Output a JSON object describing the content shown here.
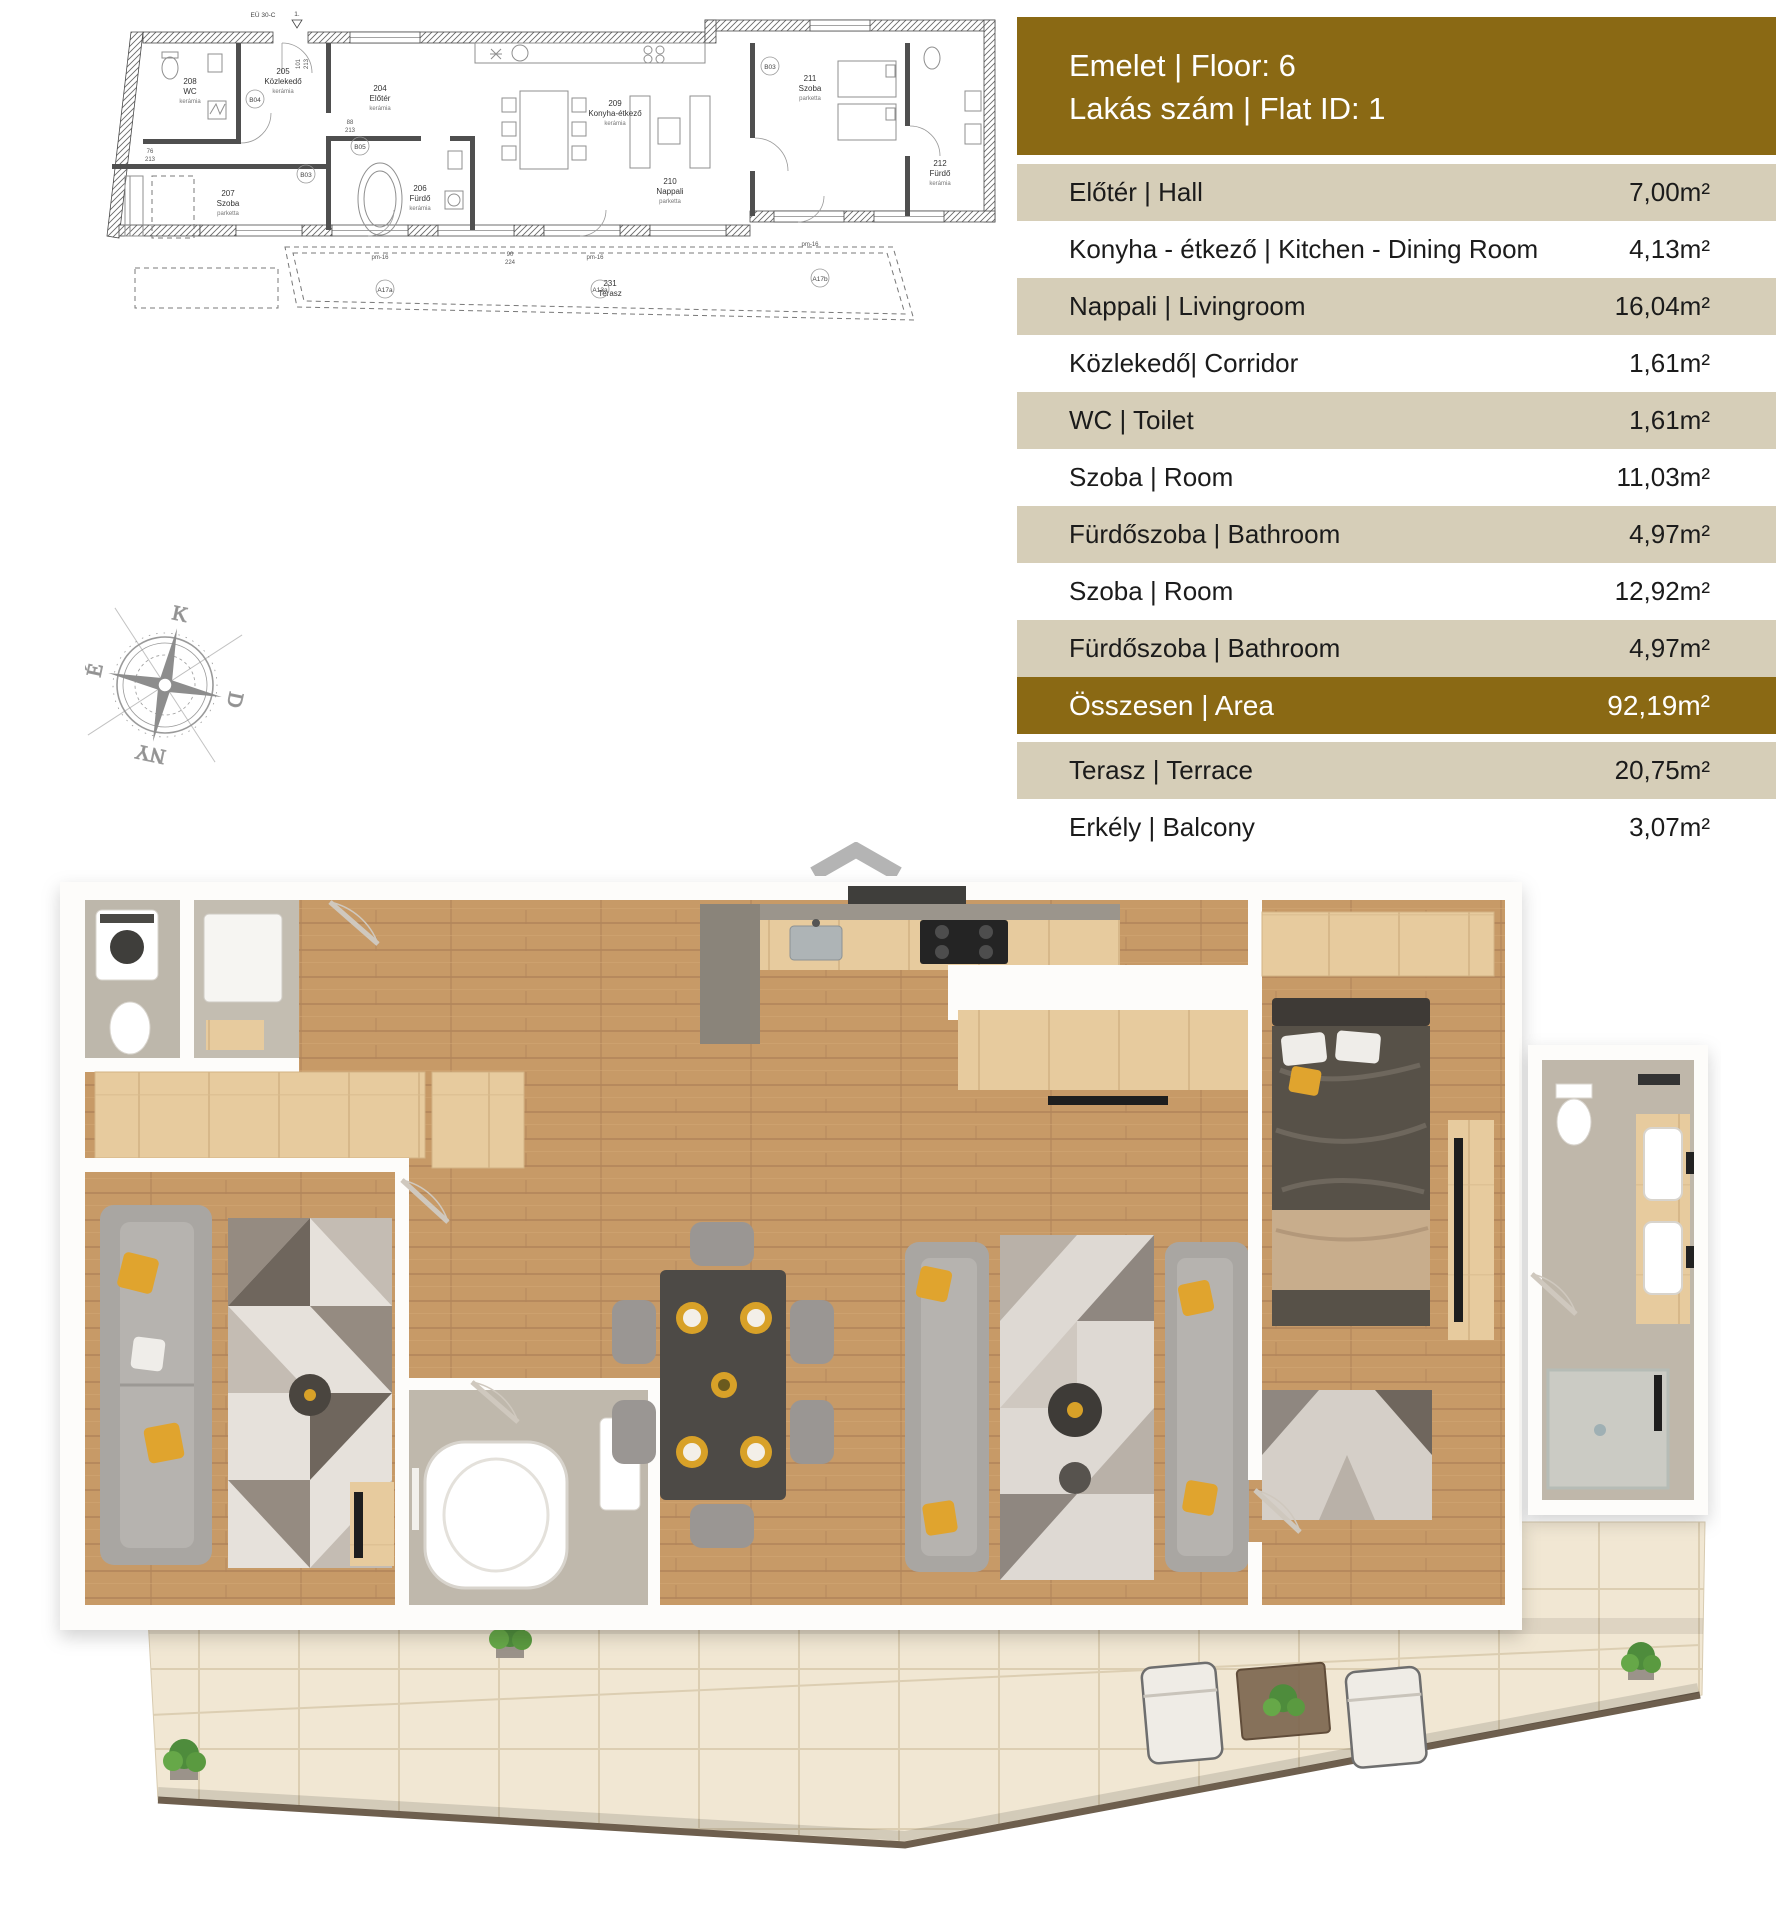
{
  "header": {
    "line1": "Emelet | Floor: 6",
    "line2": "Lakás szám | Flat ID: 1"
  },
  "table": {
    "rows": [
      {
        "label": "Előtér | Hall",
        "value": "7,00m²"
      },
      {
        "label": "Konyha - étkező | Kitchen - Dining Room",
        "value": "4,13m²"
      },
      {
        "label": "Nappali | Livingroom",
        "value": "16,04m²"
      },
      {
        "label": "Közlekedő| Corridor",
        "value": "1,61m²"
      },
      {
        "label": "WC | Toilet",
        "value": "1,61m²"
      },
      {
        "label": "Szoba | Room",
        "value": "11,03m²"
      },
      {
        "label": "Fürdőszoba | Bathroom",
        "value": "4,97m²"
      },
      {
        "label": "Szoba | Room",
        "value": "12,92m²"
      },
      {
        "label": "Fürdőszoba | Bathroom",
        "value": "4,97m²"
      },
      {
        "label": "Összesen | Area",
        "value": "92,19m²"
      },
      {
        "label": "Terasz | Terrace",
        "value": "20,75m²"
      },
      {
        "label": "Erkély | Balcony",
        "value": "3,07m²"
      }
    ]
  },
  "logo": {
    "letters": "OC",
    "line1": "OTTHON",
    "line2": "CENTRUM"
  },
  "compass": {
    "top": "K",
    "right": "D",
    "bottom": "NY",
    "left": "É"
  },
  "plan2d": {
    "entrance": {
      "no": "1.",
      "label": "EÜ 30-C"
    },
    "rooms": [
      {
        "id": "208",
        "name": "WC",
        "floor": "kerámia"
      },
      {
        "id": "205",
        "name": "Közlekedő",
        "floor": "kerámia"
      },
      {
        "id": "204",
        "name": "Előtér",
        "floor": "kerámia"
      },
      {
        "id": "209",
        "name": "Konyha-étkező",
        "floor": "kerámia"
      },
      {
        "id": "210",
        "name": "Nappali",
        "floor": "parketta"
      },
      {
        "id": "211",
        "name": "Szoba",
        "floor": "parketta"
      },
      {
        "id": "207",
        "name": "Szoba",
        "floor": "parketta"
      },
      {
        "id": "206",
        "name": "Fürdő",
        "floor": "kerámia"
      },
      {
        "id": "212",
        "name": "Fürdő",
        "floor": "kerámia"
      },
      {
        "id": "231",
        "name": "Terasz",
        "floor": ""
      }
    ],
    "door_tags": [
      "B04",
      "B05",
      "B03",
      "B03"
    ],
    "window_tags": [
      "A17a",
      "A13a",
      "A17b"
    ],
    "window_label": "pm-16",
    "dims": [
      {
        "a": "101",
        "b": "213"
      },
      {
        "a": "88",
        "b": "213"
      },
      {
        "a": "76",
        "b": "213"
      },
      {
        "a": "90",
        "b": "224"
      }
    ]
  },
  "colors": {
    "accent_gold": "#8A6914",
    "row_beige": "#D6CEB8",
    "logo_gray": "#B4B4B4",
    "wood": "#C79A67",
    "terrace_tile": "#F1E7D3",
    "pillow_yellow": "#E0A42E"
  }
}
